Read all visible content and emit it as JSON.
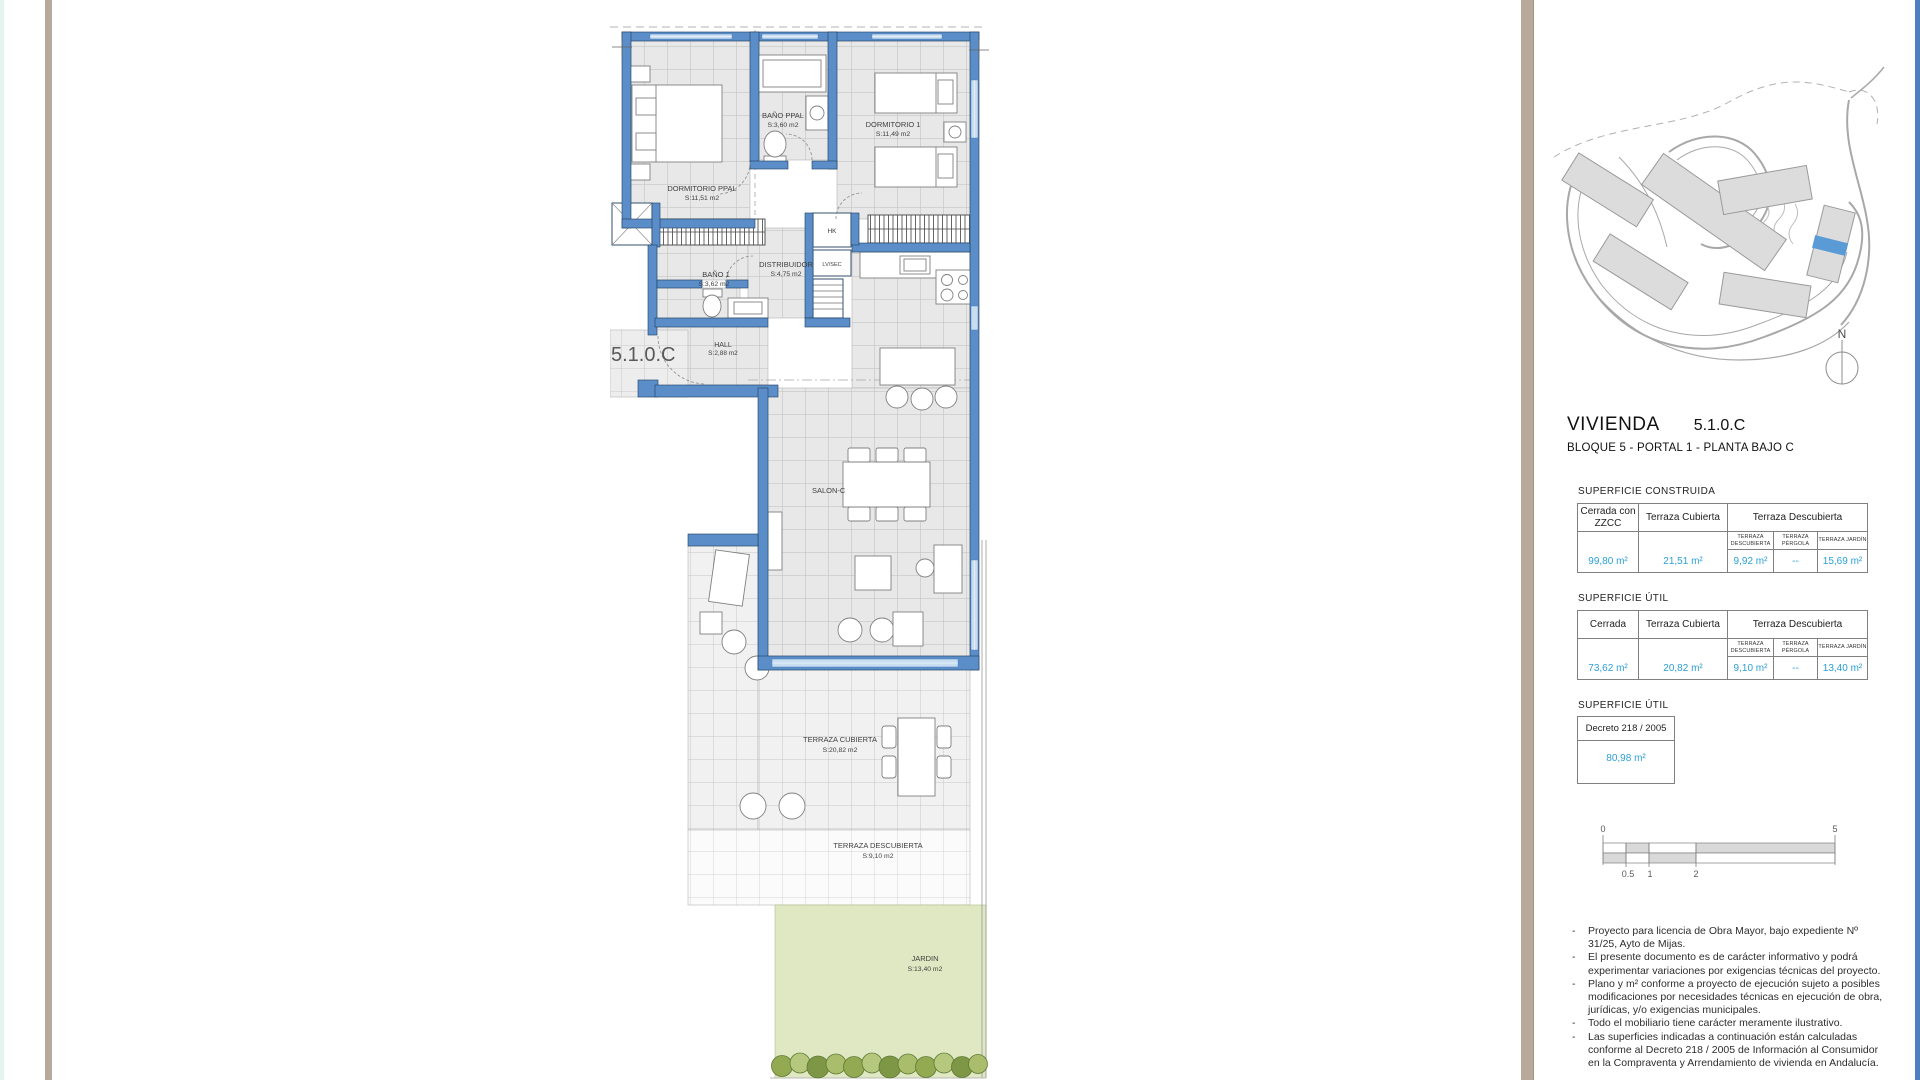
{
  "title": {
    "main": "VIVIENDA",
    "code": "5.1.0.C",
    "subtitle": "BLOQUE 5 - PORTAL 1 - PLANTA BAJO C"
  },
  "plan": {
    "unit_label": "5.1.0.C",
    "rooms": [
      {
        "name": "DORMITORIO PPAL",
        "area": "S:11,51 m2"
      },
      {
        "name": "BAÑO PPAL",
        "area": "S:3,60 m2"
      },
      {
        "name": "DORMITORIO 1",
        "area": "S:11,49 m2"
      },
      {
        "name": "DISTRIBUIDOR",
        "area": "S:4,75 m2"
      },
      {
        "name": "BAÑO 1",
        "area": "S:3,62 m2"
      },
      {
        "name": "HALL",
        "area": "S:2,88 m2"
      },
      {
        "name": "SALON-C",
        "area": ""
      },
      {
        "name": "TERRAZA CUBIERTA",
        "area": "S:20,82 m2"
      },
      {
        "name": "TERRAZA DESCUBIERTA",
        "area": "S:9,10 m2"
      },
      {
        "name": "JARDIN",
        "area": "S:13,40 m2"
      }
    ],
    "fixtures": {
      "hk": "HK",
      "lvsec": "LV/SEC"
    }
  },
  "sitemap": {
    "north_label": "N"
  },
  "tables": [
    {
      "section_label": "SUPERFICIE CONSTRUIDA",
      "col1": "Cerrada con ZZCC",
      "col2": "Terraza Cubierta",
      "col3": "Terraza Descubierta",
      "sub": [
        "TERRAZA DESCUBIERTA",
        "TERRAZA PÉRGOLA",
        "TERRAZA JARDÍN"
      ],
      "values": [
        "99,80 m²",
        "21,51 m²",
        "9,92 m²",
        "--",
        "15,69 m²"
      ]
    },
    {
      "section_label": "SUPERFICIE ÚTIL",
      "col1": "Cerrada",
      "col2": "Terraza Cubierta",
      "col3": "Terraza Descubierta",
      "sub": [
        "TERRAZA DESCUBIERTA",
        "TERRAZA PÉRGOLA",
        "TERRAZA JARDÍN"
      ],
      "values": [
        "73,62 m²",
        "20,82 m²",
        "9,10 m²",
        "--",
        "13,40 m²"
      ]
    }
  ],
  "decreto": {
    "section_label": "SUPERFICIE ÚTIL",
    "header": "Decreto  218 / 2005",
    "value": "80,98 m²"
  },
  "scalebar": {
    "zero": "0",
    "half": "0.5",
    "one": "1",
    "two": "2",
    "five": "5"
  },
  "notes": {
    "bullet": "-",
    "items": [
      "Proyecto para licencia de Obra Mayor, bajo expediente Nº 31/25, Ayto de Mijas.",
      "El presente documento es de carácter informativo y podrá experimentar variaciones por exigencias técnicas del proyecto.",
      "Plano y m² conforme a proyecto de ejecución sujeto a posibles modificaciones por necesidades técnicas en ejecución de obra, jurídicas, y/o exigencias municipales.",
      "Todo el mobiliario tiene carácter meramente ilustrativo.",
      "Las superficies indicadas a continuación están calculadas conforme al Decreto 218 / 2005  de Información al Consumidor en la Compraventa y Arrendamiento de vivienda en Andalucía."
    ]
  },
  "colors": {
    "wall_blue": "#5b8ec9",
    "highlight_blue": "#5b9bd5",
    "value_text_blue": "#2b9fd6",
    "garden_green": "#dfe8c3",
    "frame_tan": "#b8aa9b"
  }
}
